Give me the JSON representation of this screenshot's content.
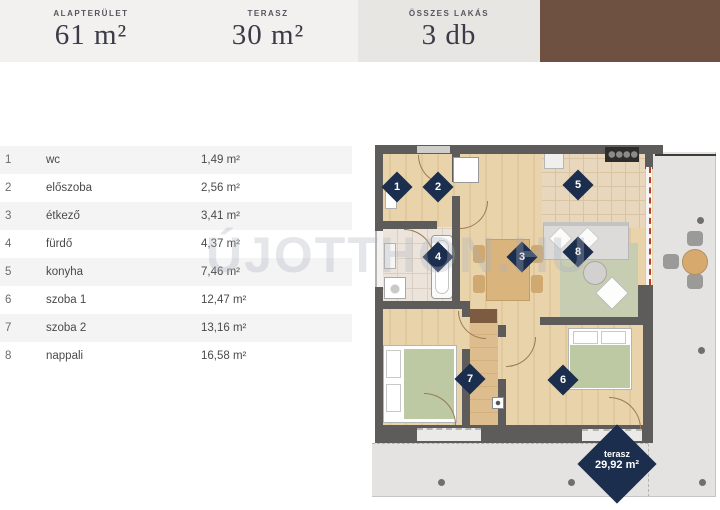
{
  "header": {
    "stats": [
      {
        "label": "ALAPTERÜLET",
        "value": "61 m²"
      },
      {
        "label": "TERASZ",
        "value": "30 m²"
      },
      {
        "label": "ÖSSZES LAKÁS",
        "value": "3 db"
      }
    ],
    "brown_color": "#6e5140"
  },
  "table": {
    "rows": [
      {
        "num": "1",
        "name": "wc",
        "area": "1,49 m²"
      },
      {
        "num": "2",
        "name": "előszoba",
        "area": "2,56 m²"
      },
      {
        "num": "3",
        "name": "étkező",
        "area": "3,41 m²"
      },
      {
        "num": "4",
        "name": "fürdő",
        "area": "4,37 m²"
      },
      {
        "num": "5",
        "name": "konyha",
        "area": "7,46 m²"
      },
      {
        "num": "6",
        "name": "szoba 1",
        "area": "12,47 m²"
      },
      {
        "num": "7",
        "name": "szoba 2",
        "area": "13,16 m²"
      },
      {
        "num": "8",
        "name": "nappali",
        "area": "16,58 m²"
      }
    ]
  },
  "plan": {
    "markers": [
      "1",
      "2",
      "3",
      "4",
      "5",
      "6",
      "7",
      "8"
    ],
    "terrace_label": {
      "title": "terasz",
      "area": "29,92 m²"
    }
  },
  "watermark": "ÚJOTTHON.HU",
  "colors": {
    "accent_navy": "#1c2e4e",
    "wall_gray": "#5d5c5a",
    "wood_floor": "#e9d3ab",
    "terrace_gray": "#e4e3e1",
    "header_gray": "#f2f1ef"
  }
}
